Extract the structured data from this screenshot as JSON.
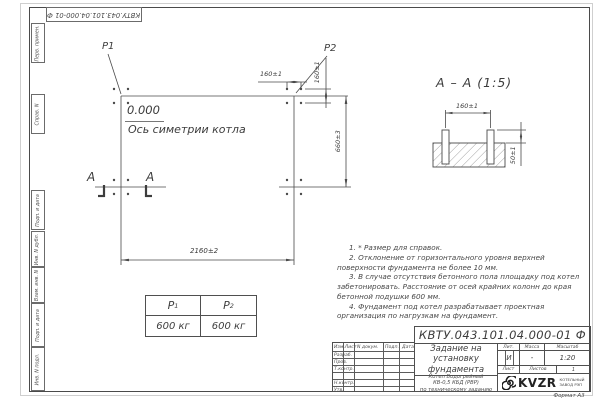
{
  "stamp_top": {
    "doc_number_rotated": "КВТУ.043.101.04.000-01 Ф"
  },
  "margin_labels": [
    "Перв. примен.",
    "Справ. N",
    "Подп. и дата",
    "Инв. N дубл.",
    "Взам. инв. N",
    "Подп. и дата",
    "Инв. N подл."
  ],
  "plan": {
    "load_label_1": "P1",
    "load_label_2": "P2",
    "elevation": "0.000",
    "axis_label": "Ось симетрии котла",
    "section_letter_1": "А",
    "section_letter_2": "А",
    "dim_bolt_spacing_h": "160±1",
    "dim_bolt_spacing_v": "160±1",
    "dim_width": "660±3",
    "dim_length": "2160±2"
  },
  "section_view": {
    "title": "А – А (1:5)",
    "dim_bolt_spacing": "160±1",
    "dim_bolt_height": "50±1"
  },
  "load_table": {
    "col1_header": "P",
    "col1_sub": "1",
    "col2_header": "P",
    "col2_sub": "2",
    "col1_value": "600 кг",
    "col2_value": "600 кг"
  },
  "notes": [
    "1. * Размер для справок.",
    "2. Отклонение от горизонтального уровня верхней поверхности фундамента не более 10 мм.",
    "3. В случае отсутствия бетонного пола площадку под котел забетонировать. Расстояние от осей крайних колонн до края бетонной подушки 600 мм.",
    "4. Фундамент под котел разрабатывает проектная организация по нагрузкам на фундамент."
  ],
  "title_block": {
    "doc_number": "КВТУ.043.101.04.000-01 Ф",
    "title_line1": "Задание на",
    "title_line2": "установку",
    "title_line3": "фундамента",
    "subtitle_line1": "Котел Водогрейный",
    "subtitle_line2": "КВ-0,5 КБД (РВР)",
    "subtitle_line3": "по техническому заданию",
    "header_izm": "Изм.Лист",
    "header_doc": "N докум.",
    "header_podp": "Подп.",
    "header_data": "Дата",
    "rows": [
      "Разраб.",
      "Пров.",
      "Т.контр.",
      "",
      "Н.контр.",
      "Утв."
    ],
    "lit_label": "Лит.",
    "mass_label": "Масса",
    "scale_label": "Масштаб",
    "lit_value": "И",
    "mass_value": "-",
    "scale_value": "1:20",
    "sheet_label": "Лист",
    "sheets_label": "Листов",
    "sheets_value": "1",
    "logo_text": "KVZR",
    "logo_sub1": "КОТЕЛЬНЫЙ",
    "logo_sub2": "ЗАВОД РЭП",
    "format_label": "Формат А3"
  }
}
